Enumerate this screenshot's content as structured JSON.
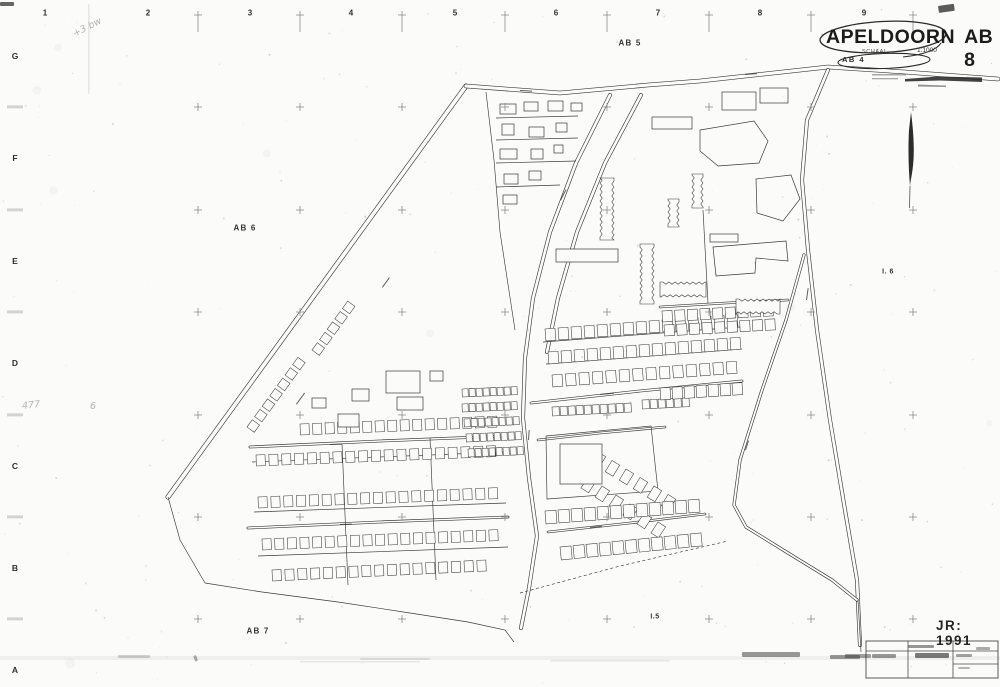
{
  "page": {
    "bg": "#fbfbf9",
    "ink": "#3a3a3a",
    "grid_color": "#8b8b8b",
    "width": 1000,
    "height": 687
  },
  "title_block": {
    "city": "APELDOORN",
    "sheet": "AB 8",
    "scale_label": "SCHAAL",
    "scale_value": "1:1000",
    "ref": "AB 4"
  },
  "year_stamp": "JR: 1991",
  "margin": {
    "top_y": 13,
    "top_numbers": [
      {
        "text": "1",
        "x": 45
      },
      {
        "text": "2",
        "x": 148
      },
      {
        "text": "3",
        "x": 250
      },
      {
        "text": "4",
        "x": 351
      },
      {
        "text": "5",
        "x": 455
      },
      {
        "text": "6",
        "x": 556
      },
      {
        "text": "7",
        "x": 658
      },
      {
        "text": "8",
        "x": 760
      },
      {
        "text": "9",
        "x": 864
      }
    ],
    "left_x": 15,
    "left_letters": [
      {
        "text": "G",
        "y": 56
      },
      {
        "text": "F",
        "y": 158
      },
      {
        "text": "E",
        "y": 261
      },
      {
        "text": "D",
        "y": 363
      },
      {
        "text": "C",
        "y": 466
      },
      {
        "text": "B",
        "y": 568
      },
      {
        "text": "A",
        "y": 670
      }
    ],
    "grid_xs": [
      198,
      300,
      402,
      505,
      607,
      709,
      811,
      913
    ],
    "grid_ys": [
      107,
      210,
      312,
      415,
      517,
      619
    ],
    "top_cross_y": 15
  },
  "area_labels": [
    {
      "text": "AB 5",
      "x": 630,
      "y": 43,
      "small": false
    },
    {
      "text": "AB 6",
      "x": 245,
      "y": 228,
      "small": false
    },
    {
      "text": "AB 7",
      "x": 258,
      "y": 631,
      "small": false
    },
    {
      "text": "I. 6",
      "x": 888,
      "y": 272,
      "small": true
    },
    {
      "text": "I.5",
      "x": 655,
      "y": 617,
      "small": true
    }
  ],
  "pencil_notes": [
    {
      "text": "477",
      "x": 22,
      "y": 400,
      "rot": -6
    },
    {
      "text": "6",
      "x": 90,
      "y": 401,
      "rot": 0
    },
    {
      "text": "+3 bw",
      "x": 72,
      "y": 22,
      "rot": -27
    }
  ],
  "map": {
    "roads": [
      {
        "p": [
          [
            168,
            497
          ],
          [
            466,
            86
          ]
        ],
        "w": 5
      },
      {
        "p": [
          [
            466,
            86
          ],
          [
            560,
            93
          ],
          [
            648,
            85
          ],
          [
            700,
            81
          ],
          [
            828,
            67
          ],
          [
            905,
            72
          ],
          [
            998,
            79
          ]
        ],
        "w": 4.5
      },
      {
        "p": [
          [
            610,
            95
          ],
          [
            576,
            163
          ],
          [
            550,
            232
          ],
          [
            533,
            298
          ],
          [
            525,
            358
          ],
          [
            523,
            418
          ],
          [
            529,
            478
          ],
          [
            537,
            536
          ],
          [
            529,
            588
          ],
          [
            521,
            628
          ]
        ],
        "w": 4
      },
      {
        "p": [
          [
            641,
            95
          ],
          [
            605,
            163
          ],
          [
            577,
            232
          ],
          [
            558,
            298
          ],
          [
            547,
            352
          ]
        ],
        "w": 4
      },
      {
        "p": [
          [
            828,
            70
          ],
          [
            807,
            120
          ],
          [
            802,
            180
          ],
          [
            808,
            250
          ],
          [
            817,
            330
          ],
          [
            830,
            420
          ],
          [
            845,
            510
          ],
          [
            857,
            580
          ],
          [
            860,
            645
          ]
        ],
        "w": 4
      },
      {
        "p": [
          [
            804,
            255
          ],
          [
            786,
            320
          ],
          [
            762,
            390
          ],
          [
            740,
            460
          ],
          [
            734,
            505
          ],
          [
            746,
            527
          ],
          [
            788,
            553
          ],
          [
            832,
            580
          ],
          [
            857,
            600
          ]
        ],
        "w": 3.2
      },
      {
        "p": [
          [
            250,
            447
          ],
          [
            380,
            441
          ],
          [
            505,
            436
          ]
        ],
        "w": 2.8
      },
      {
        "p": [
          [
            248,
            528
          ],
          [
            380,
            522
          ],
          [
            508,
            517
          ]
        ],
        "w": 2.8
      },
      {
        "p": [
          [
            531,
            403
          ],
          [
            640,
            391
          ],
          [
            742,
            381
          ]
        ],
        "w": 2.8
      },
      {
        "p": [
          [
            538,
            440
          ],
          [
            600,
            433
          ],
          [
            665,
            427
          ]
        ],
        "w": 2.6
      },
      {
        "p": [
          [
            660,
            307
          ],
          [
            726,
            303
          ],
          [
            788,
            300
          ]
        ],
        "w": 2.6
      },
      {
        "p": [
          [
            548,
            532
          ],
          [
            630,
            523
          ],
          [
            705,
            514
          ]
        ],
        "w": 2.6
      }
    ],
    "lines": [
      {
        "p": [
          [
            486,
            92
          ],
          [
            494,
            160
          ],
          [
            500,
            232
          ],
          [
            515,
            330
          ]
        ],
        "d": 0
      },
      {
        "p": [
          [
            496,
            118
          ],
          [
            578,
            116
          ]
        ],
        "d": 0
      },
      {
        "p": [
          [
            496,
            140
          ],
          [
            578,
            138
          ]
        ],
        "d": 0
      },
      {
        "p": [
          [
            496,
            163
          ],
          [
            576,
            161
          ]
        ],
        "d": 0
      },
      {
        "p": [
          [
            496,
            187
          ],
          [
            560,
            185
          ]
        ],
        "d": 0
      },
      {
        "p": [
          [
            205,
            583
          ],
          [
            262,
            592
          ],
          [
            338,
            602
          ],
          [
            410,
            613
          ],
          [
            468,
            622
          ],
          [
            505,
            630
          ],
          [
            514,
            642
          ]
        ],
        "d": 0
      },
      {
        "p": [
          [
            520,
            593
          ],
          [
            620,
            566
          ],
          [
            728,
            541
          ]
        ],
        "d": 1
      },
      {
        "p": [
          [
            168,
            497
          ],
          [
            180,
            540
          ],
          [
            205,
            583
          ]
        ],
        "d": 0
      },
      {
        "p": [
          [
            858,
            600
          ],
          [
            861,
            652
          ]
        ],
        "d": 0
      },
      {
        "p": [
          [
            546,
            436
          ],
          [
            547,
            499
          ],
          [
            658,
            491
          ],
          [
            651,
            426
          ],
          [
            546,
            436
          ]
        ],
        "d": 0
      },
      {
        "p": [
          [
            560,
            464
          ],
          [
            602,
            464
          ]
        ],
        "d": 0
      },
      {
        "p": [
          [
            252,
            462
          ],
          [
            505,
            452
          ]
        ],
        "d": 0
      },
      {
        "p": [
          [
            254,
            512
          ],
          [
            506,
            503
          ]
        ],
        "d": 0
      },
      {
        "p": [
          [
            258,
            556
          ],
          [
            508,
            547
          ]
        ],
        "d": 0
      },
      {
        "p": [
          [
            543,
            342
          ],
          [
            740,
            327
          ]
        ],
        "d": 0
      },
      {
        "p": [
          [
            546,
            364
          ],
          [
            742,
            349
          ]
        ],
        "d": 0
      },
      {
        "p": [
          [
            342,
            444
          ],
          [
            348,
            585
          ]
        ],
        "d": 0
      },
      {
        "p": [
          [
            430,
            438
          ],
          [
            436,
            580
          ]
        ],
        "d": 0
      },
      {
        "p": [
          [
            703,
            210
          ],
          [
            708,
            303
          ]
        ],
        "d": 0
      }
    ],
    "rows": [
      [
        300,
        424,
        12.5,
        -0.5,
        16,
        9,
        11
      ],
      [
        256,
        455,
        12.8,
        -0.5,
        19,
        9,
        11
      ],
      [
        258,
        497,
        12.8,
        -0.5,
        19,
        9,
        11
      ],
      [
        262,
        539,
        12.6,
        -0.5,
        19,
        9,
        11
      ],
      [
        272,
        570,
        12.8,
        -0.6,
        17,
        9,
        11
      ],
      [
        247,
        427,
        7.6,
        -10.4,
        7,
        9,
        9
      ],
      [
        312,
        350,
        7.6,
        -10.4,
        5,
        9,
        9
      ],
      [
        462,
        389,
        7,
        -0.3,
        8,
        6,
        8
      ],
      [
        462,
        404,
        7,
        -0.3,
        8,
        6,
        8
      ],
      [
        464,
        419,
        7,
        -0.3,
        8,
        6,
        8
      ],
      [
        466,
        434,
        7,
        -0.3,
        8,
        6,
        8
      ],
      [
        468,
        449,
        7,
        -0.3,
        8,
        6,
        8
      ],
      [
        545,
        329,
        13,
        -1,
        15,
        10,
        12
      ],
      [
        548,
        352,
        13,
        -1,
        15,
        10,
        12
      ],
      [
        552,
        375,
        13.4,
        -1,
        14,
        10,
        12
      ],
      [
        552,
        407,
        8,
        -0.4,
        10,
        7,
        9
      ],
      [
        642,
        400,
        8,
        -0.4,
        6,
        7,
        9
      ],
      [
        660,
        388,
        12,
        -0.8,
        7,
        10,
        12
      ],
      [
        598,
        452,
        14,
        8.5,
        6,
        9,
        13
      ],
      [
        588,
        477,
        14,
        9,
        6,
        9,
        13
      ],
      [
        545,
        511,
        13,
        -1,
        12,
        11,
        13
      ],
      [
        560,
        547,
        13,
        -1.3,
        11,
        11,
        13
      ],
      [
        662,
        311,
        12.6,
        -0.7,
        9,
        10,
        11
      ],
      [
        664,
        325,
        12.6,
        -0.7,
        9,
        10,
        11
      ]
    ],
    "rects": [
      [
        500,
        104,
        16,
        10
      ],
      [
        524,
        102,
        14,
        9
      ],
      [
        548,
        101,
        15,
        10
      ],
      [
        571,
        103,
        11,
        8
      ],
      [
        502,
        124,
        12,
        11
      ],
      [
        529,
        127,
        15,
        10
      ],
      [
        556,
        123,
        11,
        9
      ],
      [
        500,
        149,
        17,
        10
      ],
      [
        531,
        149,
        12,
        10
      ],
      [
        554,
        145,
        9,
        8
      ],
      [
        504,
        174,
        14,
        10
      ],
      [
        529,
        171,
        12,
        9
      ],
      [
        503,
        195,
        14,
        9
      ],
      [
        386,
        371,
        34,
        22
      ],
      [
        397,
        397,
        26,
        13
      ],
      [
        430,
        371,
        13,
        10
      ],
      [
        352,
        389,
        17,
        12
      ],
      [
        338,
        414,
        21,
        13
      ],
      [
        312,
        398,
        14,
        10
      ],
      [
        652,
        117,
        40,
        12
      ],
      [
        722,
        92,
        34,
        18
      ],
      [
        760,
        88,
        28,
        15
      ],
      [
        710,
        234,
        28,
        8
      ],
      [
        556,
        249,
        62,
        13
      ],
      [
        560,
        444,
        42,
        40
      ]
    ],
    "polys": [
      [
        [
          700,
          130
        ],
        [
          754,
          121
        ],
        [
          768,
          141
        ],
        [
          759,
          163
        ],
        [
          718,
          166
        ],
        [
          700,
          151
        ]
      ],
      [
        [
          756,
          179
        ],
        [
          791,
          175
        ],
        [
          800,
          199
        ],
        [
          783,
          221
        ],
        [
          757,
          213
        ]
      ],
      [
        [
          713,
          247
        ],
        [
          786,
          241
        ],
        [
          788,
          261
        ],
        [
          756,
          258
        ],
        [
          755,
          273
        ],
        [
          716,
          276
        ]
      ]
    ],
    "zigzags": [
      [
        600,
        178,
        14,
        62,
        "v"
      ],
      [
        640,
        244,
        14,
        60,
        "v"
      ],
      [
        692,
        174,
        11,
        34,
        "v"
      ],
      [
        668,
        199,
        11,
        28,
        "v"
      ],
      [
        660,
        282,
        46,
        15,
        "h"
      ],
      [
        736,
        299,
        44,
        15,
        "h"
      ]
    ],
    "marks": [
      [
        296,
        404,
        -54,
        14
      ],
      [
        382,
        287,
        -54,
        12
      ],
      [
        520,
        90,
        3,
        12
      ],
      [
        745,
        74,
        -4,
        12
      ],
      [
        560,
        200,
        -62,
        12
      ],
      [
        528,
        440,
        -86,
        10
      ],
      [
        806,
        300,
        -82,
        12
      ],
      [
        745,
        450,
        -72,
        10
      ],
      [
        600,
        394,
        -5,
        14
      ],
      [
        330,
        444,
        -2,
        12
      ],
      [
        340,
        524,
        -2,
        12
      ],
      [
        590,
        527,
        -6,
        12
      ]
    ],
    "north_arrow": {
      "x": 911,
      "top": 112,
      "bottom": 208
    }
  },
  "decor": {
    "ellipse1": [
      883,
      37,
      63,
      15.5,
      -3
    ],
    "ellipse2": [
      884,
      61,
      46,
      7.5,
      -2
    ],
    "swoosh": "M941,43 C936,51 921,55 903,57",
    "scale_bar": "M905,79 L938,76.5 L982,77.5 L982,82 L940,80.5 L905,81.5 Z",
    "scale_bar2": "M918,84.5 L946,85.5 L946,87 L918,86.5 Z",
    "text_rows": [
      [
        872,
        74,
        34,
        1.5
      ],
      [
        872,
        78,
        26,
        1.3
      ]
    ]
  },
  "stamp_table": {
    "x": 866,
    "y": 641,
    "w": 132,
    "h": 37,
    "header_y": 651,
    "cols": [
      908,
      953
    ],
    "sub": [
      953,
      998,
      664
    ]
  },
  "smudges": [
    [
      0,
      2,
      14,
      4,
      0.75,
      0
    ],
    [
      938,
      6,
      16,
      7,
      0.8,
      -8
    ],
    [
      88,
      4,
      1.5,
      90,
      0.1,
      0
    ],
    [
      0,
      656,
      1000,
      4,
      0.06,
      0
    ],
    [
      118,
      655,
      32,
      3,
      0.22,
      0
    ],
    [
      360,
      658,
      70,
      2,
      0.12,
      0
    ],
    [
      742,
      652,
      58,
      5,
      0.5,
      0
    ],
    [
      845,
      654,
      26,
      4,
      0.45,
      0
    ],
    [
      300,
      661,
      120,
      1.5,
      0.1,
      0
    ],
    [
      550,
      660,
      120,
      1.5,
      0.1,
      0
    ],
    [
      196,
      655,
      6,
      3,
      0.4,
      70
    ],
    [
      830,
      655,
      30,
      4,
      0.5,
      0
    ],
    [
      908,
      645,
      26,
      3,
      0.5,
      0
    ],
    [
      915,
      653,
      34,
      5,
      0.65,
      0
    ],
    [
      872,
      654,
      24,
      4,
      0.5,
      0
    ],
    [
      956,
      654,
      16,
      3,
      0.45,
      0
    ],
    [
      958,
      667,
      12,
      2,
      0.35,
      0
    ],
    [
      976,
      647,
      14,
      3,
      0.4,
      0
    ]
  ]
}
